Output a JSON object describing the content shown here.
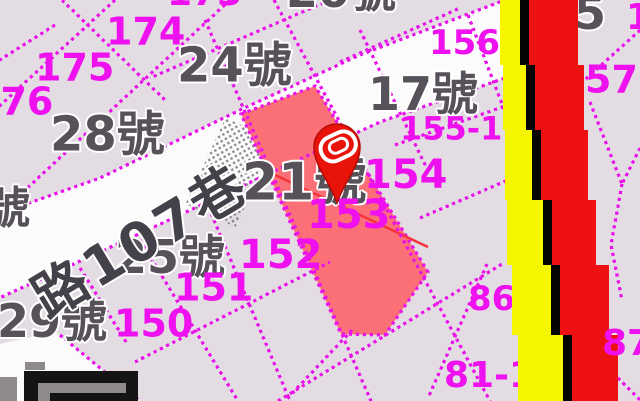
{
  "title": "cadastral-map-view",
  "colors": {
    "background": "#e3dce3",
    "road_white": "#fcfbfc",
    "parcel_line_magenta": "#ea12ea",
    "label_magenta": "#ee10ee",
    "label_gray": "#57525a",
    "label_halo": "#ffffff",
    "road_text_gray": "#45414a",
    "selected_parcel_red": "#fa7076",
    "thin_red_line": "#f5333a",
    "stripe_yellow": "#f6f600",
    "stripe_black": "#050505",
    "stripe_red": "#ee1111",
    "pin_red": "#e81309",
    "pin_outline": "#b50b04",
    "pin_glyph_white": "#ffffff",
    "logo_black": "#141414",
    "logo_gray": "#8d898d"
  },
  "map": {
    "size": {
      "w": 640,
      "h": 401
    },
    "road": {
      "points": [
        [
          -5,
          215
        ],
        [
          100,
          178
        ],
        [
          240,
          110
        ],
        [
          360,
          55
        ],
        [
          505,
          0
        ],
        [
          505,
          78
        ],
        [
          380,
          122
        ],
        [
          240,
          187
        ],
        [
          100,
          252
        ],
        [
          -5,
          300
        ]
      ]
    },
    "white_patch": {
      "points": [
        [
          -5,
          345
        ],
        [
          55,
          332
        ],
        [
          140,
          401
        ],
        [
          -5,
          401
        ]
      ]
    },
    "red_parcel": {
      "points": [
        [
          241,
          114
        ],
        [
          315,
          86
        ],
        [
          428,
          272
        ],
        [
          385,
          335
        ],
        [
          341,
          334
        ]
      ],
      "parcel_number": "153"
    },
    "red_line": {
      "x1": 258,
      "y1": 167,
      "x2": 428,
      "y2": 247
    },
    "hatch": {
      "x": 203,
      "y": 125,
      "w": 55,
      "h": 95,
      "rotate": 25
    },
    "parcel_lines": [
      [
        [
          230,
          0
        ],
        [
          -5,
          218
        ]
      ],
      [
        [
          55,
          25
        ],
        [
          -5,
          63
        ]
      ],
      [
        [
          115,
          0
        ],
        [
          -5,
          110
        ]
      ],
      [
        [
          330,
          0
        ],
        [
          150,
          78
        ]
      ],
      [
        [
          -5,
          215
        ],
        [
          100,
          178
        ],
        [
          240,
          110
        ],
        [
          360,
          55
        ],
        [
          505,
          0
        ]
      ],
      [
        [
          -5,
          300
        ],
        [
          100,
          252
        ],
        [
          240,
          187
        ],
        [
          380,
          122
        ],
        [
          505,
          78
        ]
      ],
      [
        [
          278,
          401
        ],
        [
          502,
          264
        ]
      ],
      [
        [
          135,
          362
        ],
        [
          330,
          262
        ]
      ],
      [
        [
          274,
          0
        ],
        [
          490,
          401
        ]
      ],
      [
        [
          205,
          20
        ],
        [
          371,
          401
        ]
      ],
      [
        [
          195,
          175
        ],
        [
          290,
          401
        ]
      ],
      [
        [
          140,
          240
        ],
        [
          238,
          401
        ]
      ],
      [
        [
          80,
          268
        ],
        [
          128,
          345
        ]
      ],
      [
        [
          60,
          335
        ],
        [
          140,
          401
        ]
      ],
      [
        [
          62,
          0
        ],
        [
          165,
          100
        ]
      ],
      [
        [
          360,
          30
        ],
        [
          430,
          175
        ]
      ],
      [
        [
          468,
          15
        ],
        [
          512,
          130
        ]
      ],
      [
        [
          340,
          62
        ],
        [
          460,
          8
        ]
      ],
      [
        [
          395,
          145
        ],
        [
          508,
          105
        ]
      ],
      [
        [
          420,
          218
        ],
        [
          508,
          180
        ]
      ],
      [
        [
          487,
          264
        ],
        [
          428,
          398
        ]
      ],
      [
        [
          352,
          330
        ],
        [
          285,
          401
        ]
      ],
      [
        [
          640,
          30
        ],
        [
          585,
          80
        ]
      ],
      [
        [
          590,
          102
        ],
        [
          622,
          184
        ]
      ],
      [
        [
          640,
          148
        ],
        [
          622,
          184
        ]
      ],
      [
        [
          622,
          184
        ],
        [
          611,
          245
        ],
        [
          622,
          300
        ]
      ],
      [
        [
          598,
          358
        ],
        [
          640,
          400
        ]
      ]
    ],
    "stripes": {
      "ys": [
        0,
        65,
        130,
        200,
        265,
        335,
        401
      ],
      "yellow_left": [
        500,
        503,
        505,
        507,
        512,
        518
      ],
      "yellow_right": [
        520,
        526,
        532,
        543,
        551,
        563
      ],
      "black_right": [
        529,
        535,
        541,
        552,
        560,
        572
      ],
      "red_right": [
        578,
        584,
        588,
        596,
        609,
        618
      ]
    }
  },
  "labels": {
    "gray": [
      {
        "text": "20號",
        "x": 286,
        "y": -30,
        "size": 46
      },
      {
        "text": "24號",
        "x": 177,
        "y": 43,
        "size": 48
      },
      {
        "text": "28號",
        "x": 50,
        "y": 112,
        "size": 48
      },
      {
        "text": "17號",
        "x": 368,
        "y": 73,
        "size": 46
      },
      {
        "text": "21號",
        "x": 242,
        "y": 158,
        "size": 52
      },
      {
        "text": "25號",
        "x": 115,
        "y": 236,
        "size": 46
      },
      {
        "text": "29號",
        "x": -3,
        "y": 300,
        "size": 46
      },
      {
        "text": "號",
        "x": -14,
        "y": 188,
        "size": 44
      },
      {
        "text": "5",
        "x": 574,
        "y": -8,
        "size": 46
      }
    ],
    "magenta_under_stripes": [
      {
        "text": "173",
        "x": 167,
        "y": -24,
        "size": 36
      },
      {
        "text": "174",
        "x": 106,
        "y": 14,
        "size": 38
      },
      {
        "text": "175",
        "x": 35,
        "y": 50,
        "size": 38
      },
      {
        "text": "176",
        "x": -26,
        "y": 84,
        "size": 38
      },
      {
        "text": "156",
        "x": 429,
        "y": 27,
        "size": 34
      },
      {
        "text": "155-1",
        "x": 400,
        "y": 114,
        "size": 32
      },
      {
        "text": "154",
        "x": 364,
        "y": 156,
        "size": 40
      },
      {
        "text": "153",
        "x": 307,
        "y": 196,
        "size": 40
      },
      {
        "text": "152",
        "x": 239,
        "y": 236,
        "size": 40
      },
      {
        "text": "151",
        "x": 174,
        "y": 270,
        "size": 38
      },
      {
        "text": "150",
        "x": 114,
        "y": 306,
        "size": 38
      },
      {
        "text": "86",
        "x": 468,
        "y": 283,
        "size": 34
      },
      {
        "text": "81-1",
        "x": 444,
        "y": 358,
        "size": 36
      }
    ],
    "magenta_over_stripes": [
      {
        "text": "57",
        "x": 585,
        "y": 62,
        "size": 38
      },
      {
        "text": "87",
        "x": 602,
        "y": 326,
        "size": 36
      },
      {
        "text": "15",
        "x": 626,
        "y": 0,
        "size": 36
      }
    ],
    "road_label": {
      "text": "路107巷",
      "x": 25,
      "y": 282,
      "size": 54,
      "rotate": -31,
      "letter_spacing": 4
    }
  },
  "pin": {
    "cx": 337,
    "cy": 147,
    "r": 23,
    "tip_y": 203
  },
  "logo": {
    "rects": [
      {
        "x": 24,
        "y": 371,
        "w": 114,
        "h": 30,
        "color_key": "logo_black"
      },
      {
        "x": 38,
        "y": 383,
        "w": 88,
        "h": 18,
        "color_key": "logo_gray"
      },
      {
        "x": 50,
        "y": 393,
        "w": 88,
        "h": 8,
        "color_key": "logo_black"
      },
      {
        "x": 0,
        "y": 377,
        "w": 17,
        "h": 24,
        "color_key": "logo_gray"
      },
      {
        "x": 25,
        "y": 362,
        "w": 20,
        "h": 8,
        "color_key": "logo_gray"
      }
    ]
  }
}
